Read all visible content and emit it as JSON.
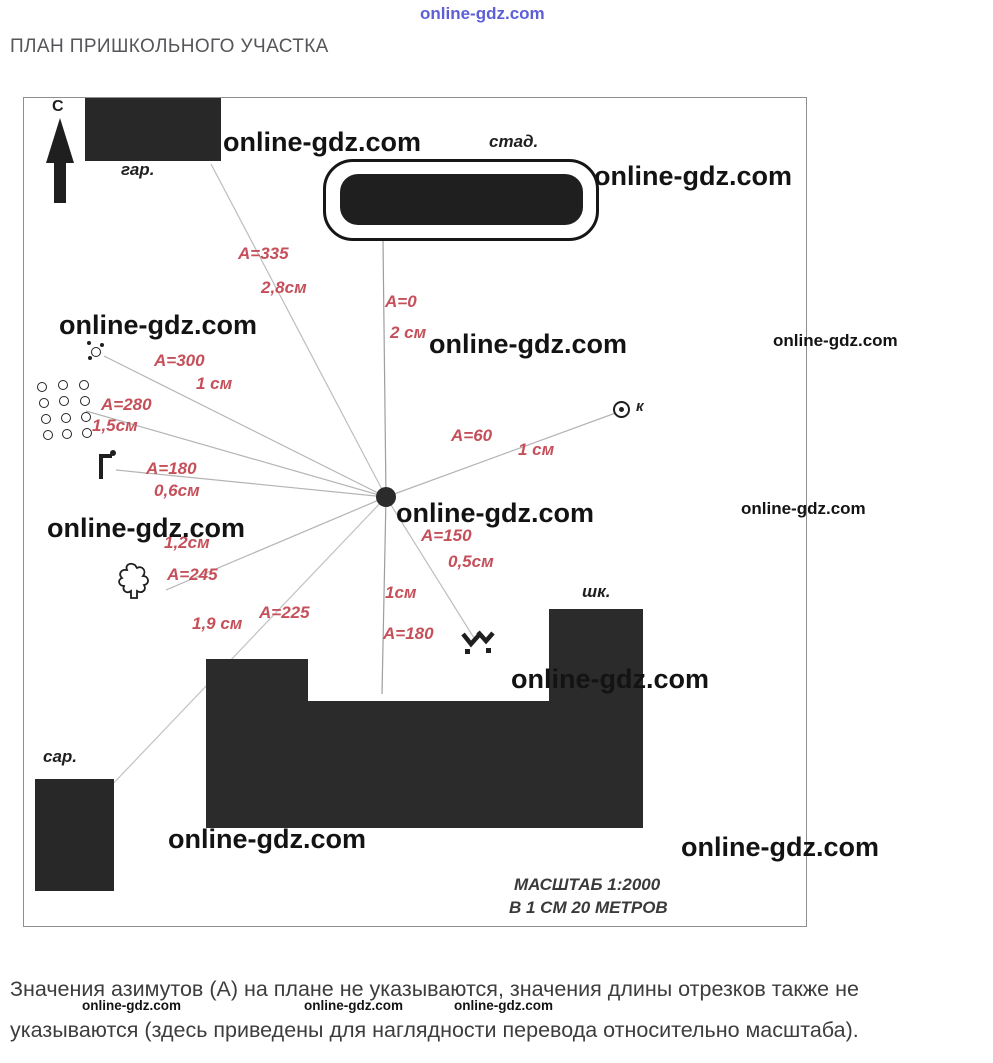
{
  "watermark": {
    "text": "online-gdz.com"
  },
  "page": {
    "title": "ПЛАН ПРИШКОЛЬНОГО УЧАСТКА",
    "footnote_line1": "Значения азимутов (А) на плане не указываются, значения длины отрезков также не",
    "footnote_line2": "указываются (здесь приведены для наглядности перевода относительно масштаба)."
  },
  "map": {
    "north_label": "С",
    "labels": {
      "garage": "гар.",
      "stadium": "стад.",
      "school": "шк.",
      "shed": "сар.",
      "point_k": "к"
    },
    "scale_line1": "МАСШТАБ 1:2000",
    "scale_line2": "В 1 СМ 20 МЕТРОВ",
    "rays": [
      {
        "target": "garage",
        "azimuth": "A=335",
        "length": "2,8см"
      },
      {
        "target": "stadium",
        "azimuth": "A=0",
        "length": "2 см"
      },
      {
        "target": "well",
        "azimuth": "A=300",
        "length": "1 см"
      },
      {
        "target": "orchard",
        "azimuth": "A=280",
        "length": "1,5см"
      },
      {
        "target": "gate",
        "azimuth": "A=180",
        "length": "0,6см"
      },
      {
        "target": "tree",
        "azimuth": "A=245",
        "length": "1,2см"
      },
      {
        "target": "shed",
        "azimuth": "A=225",
        "length": "1,9 см"
      },
      {
        "target": "school",
        "azimuth": "A=180",
        "length": "1см"
      },
      {
        "target": "spring",
        "azimuth": "A=150",
        "length": "0,5см"
      },
      {
        "target": "point-k",
        "azimuth": "A=60",
        "length": "1 см"
      }
    ],
    "colors": {
      "label_red": "#c5505a",
      "shape_dark": "#282828",
      "watermark_blue": "#4343cf",
      "ray_line": "#b4b4b4"
    }
  }
}
